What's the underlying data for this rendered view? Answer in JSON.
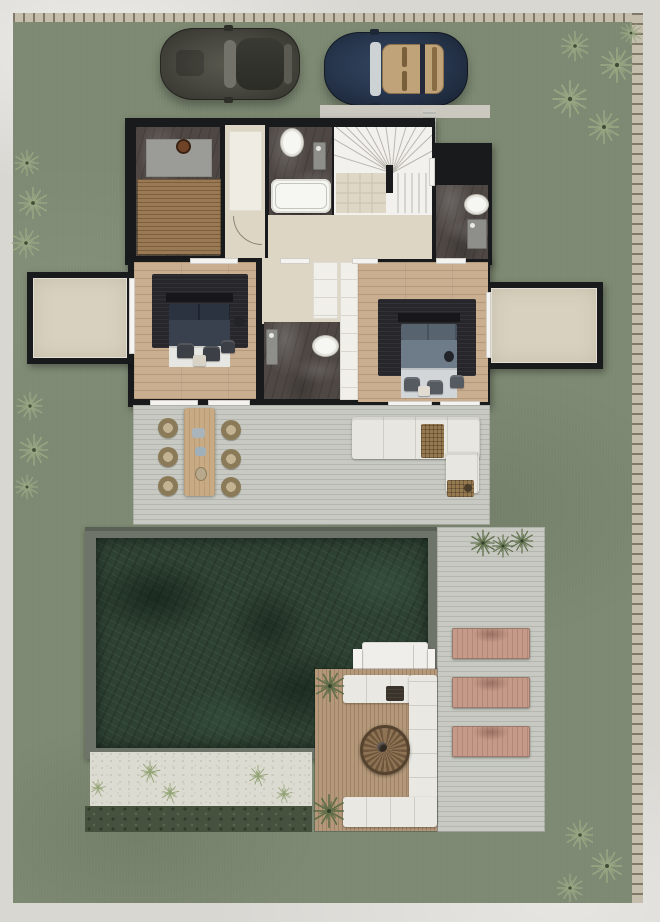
{
  "scene": {
    "type": "architectural-floor-plan-render",
    "view": "top-down",
    "subject": "villa upper floor with garden, parking, outdoor deck and pool"
  },
  "colors": {
    "margin": "#d9d7d2",
    "stone": "#c6beac",
    "lawn": "#7d8972",
    "wall": "#191a1c",
    "marble": "#4e4744",
    "beige": "#ddd6c5",
    "terrace": "#d8d1bf",
    "runner": "#efece4",
    "panel": "#f1efe9",
    "wood_floor": "#c9ae90",
    "wood_slat": "#9a7a55",
    "wood_slat_dark": "#7c5f3e",
    "rug": "#26262b",
    "deck": "#c7c9c2",
    "deck_line": "#b4b7af",
    "pool_frame": "#6f746a",
    "pool": "#2e4233",
    "pebble": "#dcdbd1",
    "hedge": "#46523e",
    "pergola": "#b49879",
    "pergola_line": "#9d8367",
    "cushion": "#e9e8e2",
    "sofa": "#e7e6e0",
    "wicker": "#96794f",
    "lounger_clay": "#c59a88",
    "lounger_white": "#efeeea",
    "table_wood": "#c8ab85",
    "chair_dark": "#3c4046",
    "chair_gray": "#565b62",
    "palm": "#9aa884",
    "plant_dark": "#5a6b45",
    "tuft": "#8ea06f",
    "car_dark": "#4a4942",
    "car_blue": "#27364d",
    "car_interior": "#c0a378",
    "white_fix": "#f6f6f3",
    "window": "#f4f3ef",
    "sink": "#8e8f8b",
    "fire_pit": "#8e7355",
    "fire_pit_dark": "#6e563c"
  },
  "garden": {
    "boundary": "stone wall along top and right edges",
    "palm_groups": [
      "top-right",
      "left-upper",
      "left-middle",
      "bottom-right"
    ],
    "hedge": "dark clipped hedge strip below pool",
    "gravel_bed": "white pebble bed with grass tufts along pool south side"
  },
  "vehicles": [
    {
      "name": "sedan",
      "color_key": "car_dark",
      "position": "parked top-left on lawn"
    },
    {
      "name": "convertible",
      "color_key": "car_blue",
      "detail": "open top with tan leather interior",
      "position": "parked top-right of sedan"
    }
  ],
  "house": {
    "rooms": [
      {
        "name": "spa-room",
        "floor": "dark marble with wood slat platform and grey mat"
      },
      {
        "name": "entry-corridor",
        "floor": "beige with white runner"
      },
      {
        "name": "bathroom-top",
        "fixtures": [
          "toilet",
          "wall sink",
          "bathtub"
        ]
      },
      {
        "name": "staircase",
        "style": "fan winder stairs with tiled landing"
      },
      {
        "name": "bathroom-right-wing",
        "fixtures": [
          "bathtub",
          "toilet",
          "wall sink"
        ]
      },
      {
        "name": "bedroom-left",
        "furniture": [
          "double bed",
          "dark area rug",
          "two armchairs",
          "coffee table",
          "stool"
        ]
      },
      {
        "name": "bathroom-middle",
        "fixtures": [
          "wall sink",
          "toilet",
          "bathtub"
        ]
      },
      {
        "name": "wardrobe-closets",
        "finish": "white panels"
      },
      {
        "name": "bedroom-right",
        "furniture": [
          "double bed",
          "dark area rug",
          "armchairs",
          "coffee table",
          "stool"
        ]
      },
      {
        "name": "terrace-left",
        "finish": "beige stone"
      },
      {
        "name": "terrace-right",
        "finish": "beige stone"
      }
    ]
  },
  "outdoor": {
    "main_deck": {
      "dining": {
        "table": "wood dining table",
        "chairs": 6
      },
      "lounge": {
        "sofa": "L-shaped white sofa",
        "ottoman": "wicker ottoman",
        "side_table": "wicker side table with plant pot"
      }
    },
    "pool": {
      "finish": "dark green stone",
      "coping": "grey frame"
    },
    "white_sun_loungers": 2,
    "clay_sun_loungers": 3,
    "fire_lounge": {
      "platform": "wood slat deck",
      "seating": "U-shaped white outdoor cushions",
      "fire_pit": "round rattan fire table",
      "bench": "dark slatted bench"
    }
  }
}
